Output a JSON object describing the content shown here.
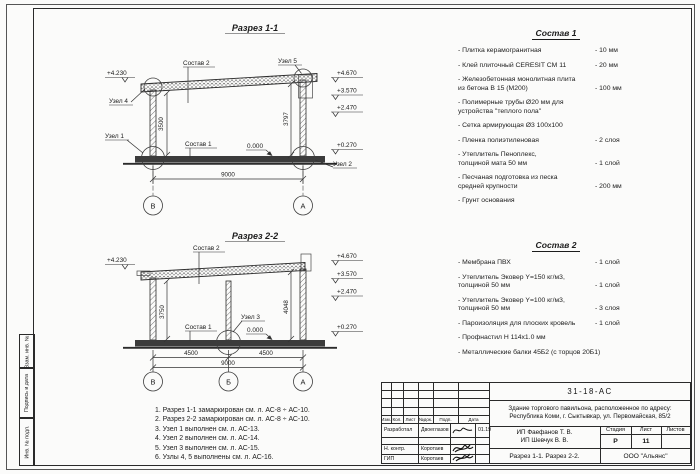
{
  "section1": {
    "title": "Разрез 1-1",
    "elev_left": "+4.230",
    "elevations": [
      "+4.670",
      "+3.570",
      "+2.470",
      "+0.270"
    ],
    "zero": "0.000",
    "dim_left": "3500",
    "dim_right": "3797",
    "dim_span": "9000",
    "axes": [
      "В",
      "А"
    ],
    "label_sostav2": "Состав 2",
    "label_sostav1": "Состав 1",
    "label_uzel1": "Узел 1",
    "label_uzel2": "Узел 2",
    "label_uzel4": "Узел 4",
    "label_uzel5": "Узел 5"
  },
  "section2": {
    "title": "Разрез 2-2",
    "elev_left": "+4.230",
    "elevations": [
      "+4.670",
      "+3.570",
      "+2.470",
      "+0.270"
    ],
    "zero": "0.000",
    "dim_left": "3750",
    "dim_right": "4048",
    "dims_bottom": [
      "4500",
      "4500"
    ],
    "dim_span": "9000",
    "axes": [
      "В",
      "Б",
      "А"
    ],
    "label_sostav2": "Состав 2",
    "label_sostav1": "Состав 1",
    "label_uzel3": "Узел 3"
  },
  "sostav1": {
    "title": "Состав 1",
    "items": [
      {
        "name": "- Плитка керамогранитная",
        "value": "-  10 мм"
      },
      {
        "name": "- Клей плиточный CERESIT CM 11",
        "value": "-  20 мм"
      },
      {
        "name": "- Железобетонная  монолитная плита\nиз бетона В 15 (М200)",
        "value": "- 100 мм"
      },
      {
        "name": "- Полимерные трубы Ø20 мм для\nустройства \"теплого пола\"",
        "value": ""
      },
      {
        "name": "- Сетка армирующая Ø3 100х100",
        "value": ""
      },
      {
        "name": "- Пленка полиэтиленовая",
        "value": "-  2 слоя"
      },
      {
        "name": "- Утеплитель Пеноплекс,\nтолщиной мата 50 мм",
        "value": "- 1 слой"
      },
      {
        "name": "- Песчаная подготовка из песка\nсредней крупности",
        "value": "- 200 мм"
      },
      {
        "name": "- Грунт основания",
        "value": ""
      }
    ]
  },
  "sostav2": {
    "title": "Состав 2",
    "items": [
      {
        "name": "- Мембрана ПВХ",
        "value": "- 1 слой"
      },
      {
        "name": "- Утеплитель Эковер Y=150 кг/м3,\nтолщиной 50 мм",
        "value": "- 1 слой"
      },
      {
        "name": "- Утеплитель Эковер Y=100 кг/м3,\nтолщиной 50 мм",
        "value": "- 3 слоя"
      },
      {
        "name": "- Пароизоляция для плоских кровель",
        "value": "- 1 слой"
      },
      {
        "name": "- Профнастил Н 114х1.0 мм",
        "value": ""
      },
      {
        "name": "- Металлические балки 45Б2 (с торцов 20Б1)",
        "value": ""
      }
    ]
  },
  "notes": [
    "1. Разрез 1-1 замаркирован см. л. АС-8 ÷ АС-10.",
    "2. Разрез 2-2 замаркирован см. л. АС-8 ÷ АС-10.",
    "3. Узел 1 выполнен см. л. АС-13.",
    "4. Узел 2 выполнен см. л. АС-14.",
    "5. Узел 3 выполнен см. л. АС-15.",
    "6. Узлы 4, 5 выполнены см. л. АС-16."
  ],
  "stamp": {
    "doc_number": "31-18-АС",
    "description": "Здание торгового павильона, расположенное по адресу: Республика Коми, г. Сыктывкар, ул. Первомайская, 85/2",
    "cols": {
      "izm": "Изм.",
      "kol": "Кол.",
      "list": "Лист",
      "ndok": "№док.",
      "podp": "Подп.",
      "data": "Дата"
    },
    "rows": [
      {
        "role": "Разработал",
        "name": "Двоеглазов",
        "date": "01.19"
      },
      {
        "role": "Н. контр.",
        "name": "Коротаев",
        "date": ""
      },
      {
        "role": "ГИП",
        "name": "Коротаев",
        "date": ""
      }
    ],
    "clients": "ИП Фаефанов Т. В.\nИП Шевчук В. В.",
    "stage_label": "Стадия",
    "sheet_label": "Лист",
    "sheets_label": "Листов",
    "stage": "Р",
    "sheet": "11",
    "sheets": "",
    "sheet_title": "Разрез 1-1. Разрез 2-2.",
    "company": "ООО \"Альянс\""
  },
  "frame": {
    "v1": "Взам. инв. №",
    "v2": "Подпись и дата",
    "v3": "Инв. № подл."
  }
}
